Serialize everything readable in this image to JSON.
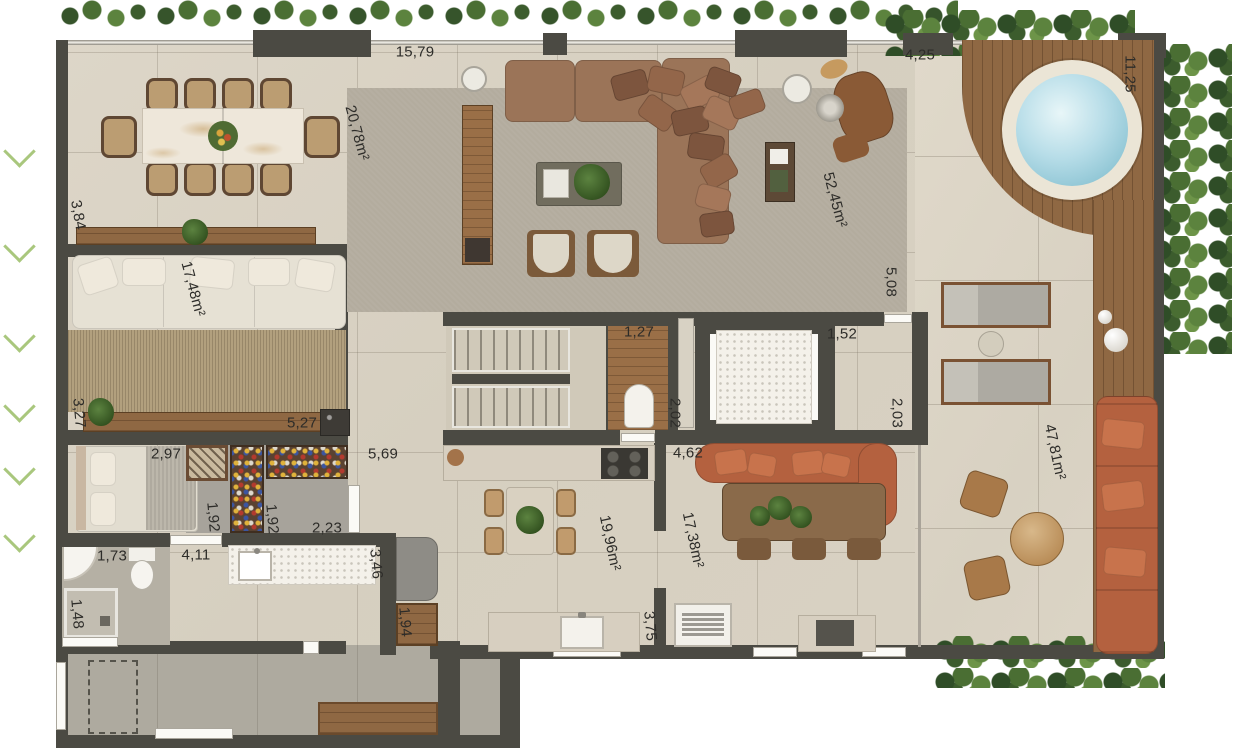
{
  "labels": [
    {
      "id": "top-width",
      "text": "15,79"
    },
    {
      "id": "dining-area",
      "text": "20,78m²"
    },
    {
      "id": "terrace-top-width",
      "text": "4,25"
    },
    {
      "id": "terrace-right-depth",
      "text": "11,25"
    },
    {
      "id": "left-dim",
      "text": "3,84"
    },
    {
      "id": "lounge-area",
      "text": "17,48m²"
    },
    {
      "id": "living-area",
      "text": "52,45m²"
    },
    {
      "id": "living-right-depth",
      "text": "5,08"
    },
    {
      "id": "wc-width",
      "text": "1,27"
    },
    {
      "id": "wc-depth",
      "text": "2,02"
    },
    {
      "id": "hall-width",
      "text": "1,52"
    },
    {
      "id": "hall-depth",
      "text": "2,03"
    },
    {
      "id": "bedroom-left-depth",
      "text": "3,27"
    },
    {
      "id": "closet-width",
      "text": "5,27"
    },
    {
      "id": "bedroom-width",
      "text": "2,97"
    },
    {
      "id": "corridor-width",
      "text": "5,69"
    },
    {
      "id": "closet-depth-1",
      "text": "1,92"
    },
    {
      "id": "closet-depth-2",
      "text": "1,92"
    },
    {
      "id": "closet-pass-width",
      "text": "2,23"
    },
    {
      "id": "dining2-opening",
      "text": "4,62"
    },
    {
      "id": "terrace-area",
      "text": "47,81m²"
    },
    {
      "id": "bath-width",
      "text": "1,73"
    },
    {
      "id": "hallway-width",
      "text": "4,11"
    },
    {
      "id": "pantry-depth",
      "text": "3,46"
    },
    {
      "id": "shower-width",
      "text": "1,48"
    },
    {
      "id": "cabinet-width",
      "text": "1,94"
    },
    {
      "id": "kitchen-area",
      "text": "19,96m²"
    },
    {
      "id": "dining2-area",
      "text": "17,38m²"
    },
    {
      "id": "bbq-wall",
      "text": "3,75"
    }
  ],
  "colors": {
    "wall": "#4b4a43",
    "floor_travertine": "#d8d1c2",
    "deck_wood": "#8f6843",
    "hot_tub_water": "#aed8e4",
    "sofa_brown": "#9b7458",
    "sofa_terracotta": "#b4613f",
    "sofa_white": "#e6e1d4",
    "greenery": "#4a6e33",
    "rug_gray": "#b3ac9e",
    "rug_jute": "#b2a07e"
  }
}
